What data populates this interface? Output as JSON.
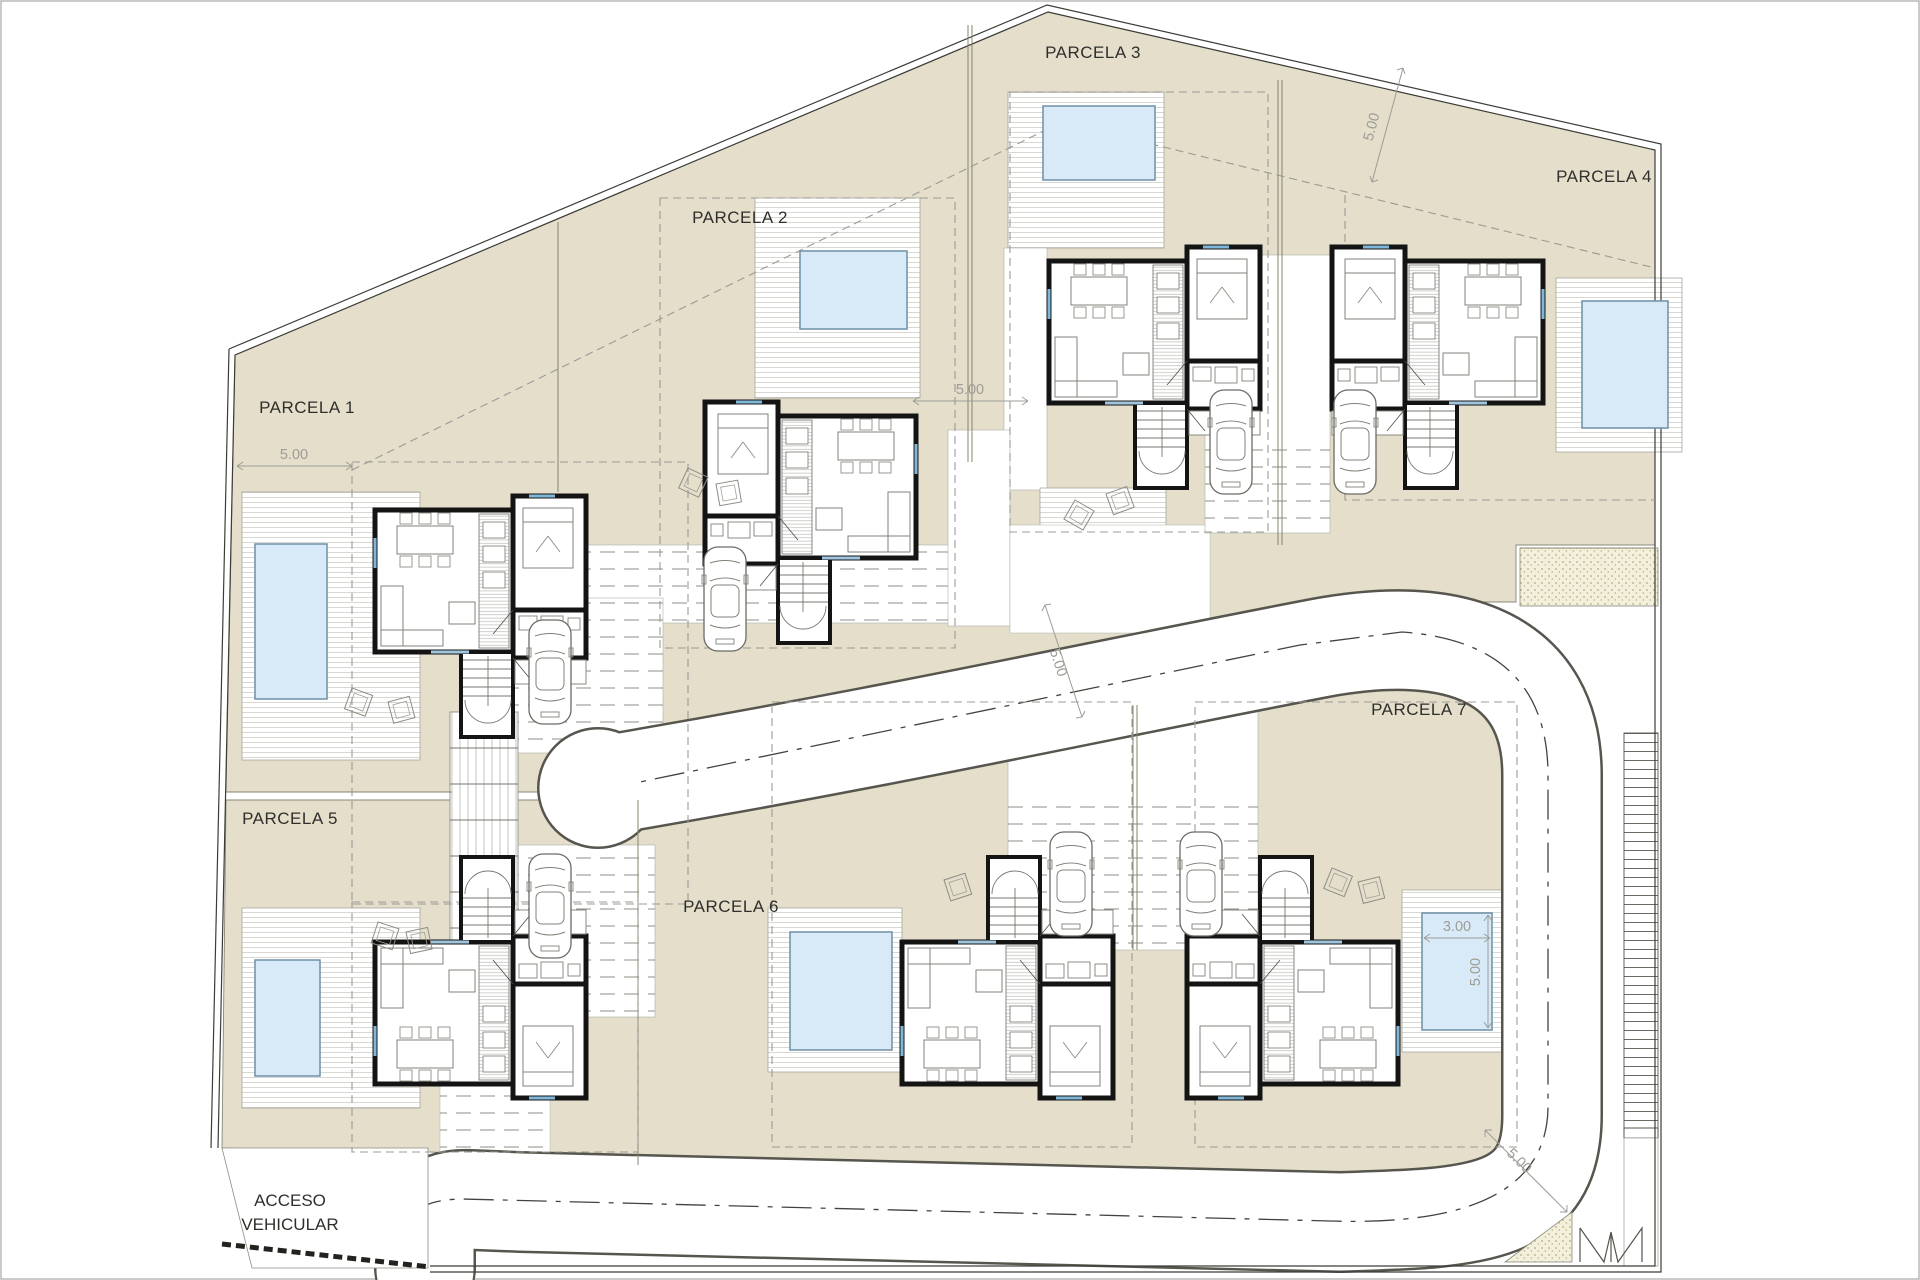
{
  "drawing": {
    "type": "residential site plan / plano de parcelación",
    "parcels": [
      {
        "label": "PARCELA 1"
      },
      {
        "label": "PARCELA 2"
      },
      {
        "label": "PARCELA 3"
      },
      {
        "label": "PARCELA 4"
      },
      {
        "label": "PARCELA 5"
      },
      {
        "label": "PARCELA 6"
      },
      {
        "label": "PARCELA 7"
      }
    ],
    "access_label": {
      "line1": "ACCESO",
      "line2": "VEHICULAR"
    },
    "dimensions": [
      {
        "text": "5.00"
      },
      {
        "text": "5.00"
      },
      {
        "text": "5.00"
      },
      {
        "text": "5.00"
      },
      {
        "text": "5.00"
      },
      {
        "text": "3.00"
      },
      {
        "text": "5.00"
      }
    ],
    "features": {
      "houses": 7,
      "pools": 7,
      "cars": 7,
      "road": "looped internal street with dash-dot centerline and cul-de-sac bulb"
    },
    "colors": {
      "parcel_fill": "#e4decb",
      "pool_fill": "#d8eaf8",
      "pool_edge": "#6f8fa6",
      "wall": "#141414",
      "road_edge": "#56564e",
      "dashed_setback": "#9b9b93"
    }
  }
}
